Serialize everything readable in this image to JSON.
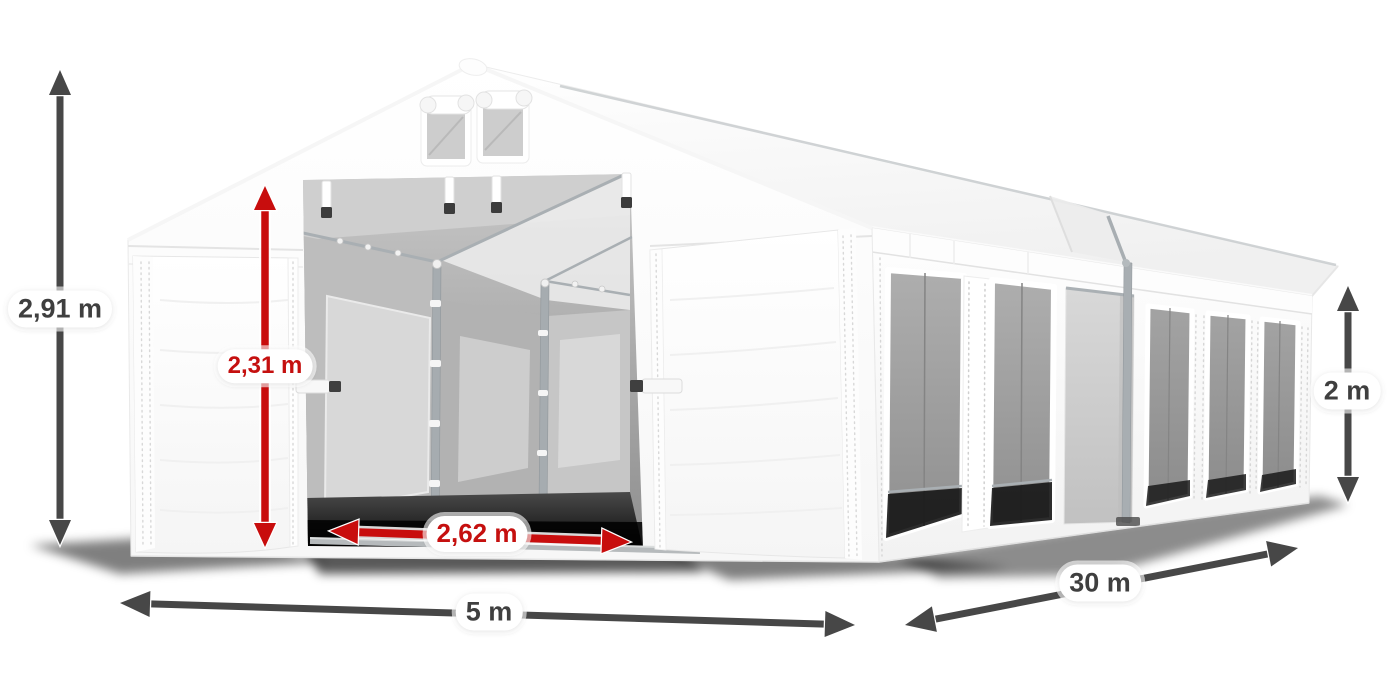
{
  "scene": {
    "description": "White PVC storage marquee tent with open front doors, gable vents and mesh side windows, annotated with dimension arrows",
    "background": "#ffffff"
  },
  "colors": {
    "dimension_dark_arrow": "#474747",
    "dimension_dark_text": "#3f3f3f",
    "dimension_red_arrow": "#c80d0d",
    "dimension_red_text": "#c5100f",
    "label_background": "#ffffff",
    "tent_fabric": "#ffffff",
    "frame_silver": "#a8aeb2"
  },
  "dimensions": {
    "total_height": {
      "label": "2,91 m"
    },
    "door_height": {
      "label": "2,31 m"
    },
    "door_width": {
      "label": "2,62 m"
    },
    "width": {
      "label": "5 m"
    },
    "length": {
      "label": "30 m"
    },
    "side_height": {
      "label": "2 m"
    }
  }
}
